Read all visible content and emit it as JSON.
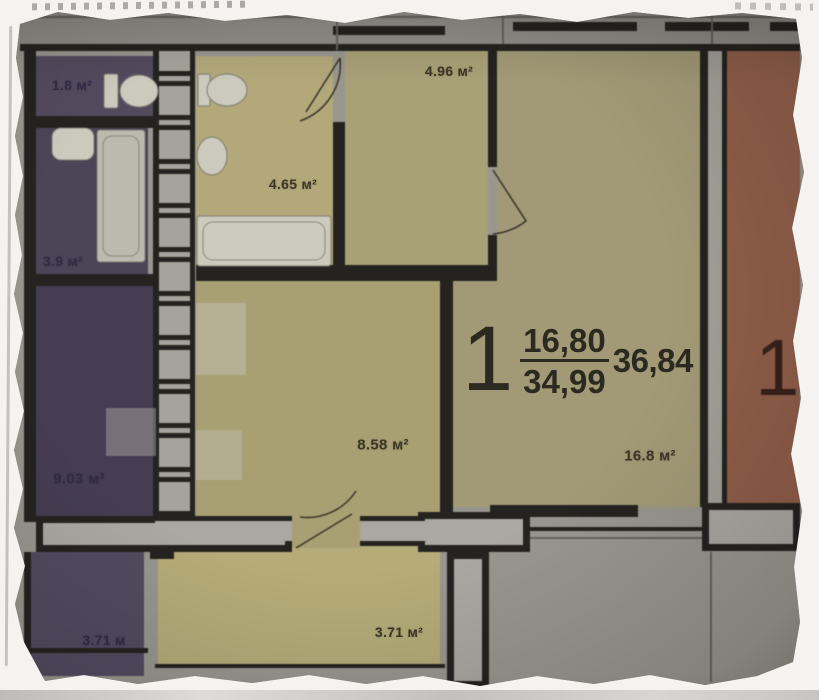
{
  "scene": {
    "kind": "photographed architectural floor plan on a torn paper scrap",
    "area_unit": "м²"
  },
  "apartment": {
    "number": "1",
    "living_area": "16,80",
    "area_without_balcony": "34,99",
    "total_area": "36,84"
  },
  "adjacent_unit": {
    "number": "1"
  },
  "labels": {
    "wc": "1.8 м²",
    "bath_left": "3.9 м²",
    "room_left": "9.03 м²",
    "balcony_left": "3.71 м",
    "bathroom": "4.65 м²",
    "hallway": "4.96 м²",
    "kitchen": "8.58 м²",
    "living": "16.8 м²",
    "balcony": "3.71 м²",
    "edge_cut": "м"
  },
  "colors": {
    "photo_bg": "#98978f",
    "top_band": "#8f8e87",
    "corridor": "#a09f98",
    "wall": "#242320",
    "wall_fill": "#a9a8a2",
    "thin_line": "#63625c",
    "purple_wc": "#544a5e",
    "purple_bath": "#4c4457",
    "purple_room": "#463d52",
    "purple_balcony": "#514b60",
    "yellow_bath": "#b2a87a",
    "yellow_hall": "#a8a077",
    "yellow_living": "#a29a76",
    "yellow_kitchen": "#a89f73",
    "yellow_balcony": "#b5ac79",
    "salmon_room": "#8f5e49",
    "fixture": "#ccc9bd",
    "tub": "#bcb9ae",
    "door_line": "#3b3729"
  }
}
